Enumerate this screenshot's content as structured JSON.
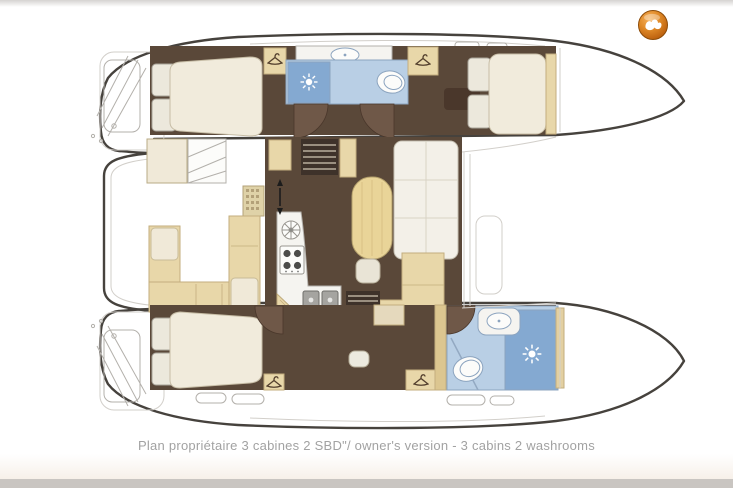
{
  "window": {
    "width": 733,
    "height": 488
  },
  "caption": {
    "text": "Plan propriétaire 3 cabines 2 SBD\"/ owner's version - 3 cabins 2 washrooms"
  },
  "branding": {
    "logo_name": "broker-logo-orange-sphere",
    "logo_glyph": "white-bird-swoosh"
  },
  "palette": {
    "hull-stroke": "#46423d",
    "deck-line": "#c8c5c0",
    "detail-gray": "#b3b0ab",
    "light-gray": "#d2cfca",
    "floor-brown": "#5a4839",
    "door-brown": "#6f5848",
    "dark-wood": "#4a372b",
    "ladder-dark": "#3e322a",
    "cream": "#f0e9d8",
    "cream-dark": "#e5d9bd",
    "tan": "#e8d7a9",
    "tan-dark": "#c3ae7e",
    "table-tan": "#e9d498",
    "counter-white": "#f5f4f0",
    "bath-floor": "#b9cfe5",
    "shower-blue": "#84a9d1",
    "bath-stroke": "#8ca4bf",
    "fixture-white": "#fcfcfa",
    "sink-gray": "#a5a4a0",
    "sink-stroke": "#6f6e6a",
    "burner-dark": "#4c4c4a",
    "mattress": "#f1ebdc",
    "mattress-stroke": "#c7bda6",
    "pillow": "#ece8dc",
    "pillow-stroke": "#a8a399",
    "grid-mat": "#dfd2a8",
    "grid-dot": "#b3a179",
    "arrow-black": "#1c1c1c",
    "icon-brown": "#54402e",
    "logo-orange": "#ce6d13",
    "logo-rim": "#8d4c08",
    "caption-gray": "#a2a2a2",
    "top-bar": "#d5d3d1",
    "bottom-bar": "#c9c5c1",
    "bottom-band": "#f7f0e9",
    "page-white": "#ffffff"
  },
  "plan": {
    "vessel": "catamaran floor plan, bow to the right",
    "rooms": [
      {
        "id": "cockpit",
        "name": "aft cockpit with U-settee and table"
      },
      {
        "id": "saloon",
        "name": "saloon with galley, dining table and sofa"
      },
      {
        "id": "port-aft-cabin",
        "name": "double cabin (port aft)"
      },
      {
        "id": "port-washroom",
        "name": "washroom with shower and toilet (port)"
      },
      {
        "id": "port-forward-cabin",
        "name": "double cabin (port forward)"
      },
      {
        "id": "owner-cabin",
        "name": "owner's double cabin (starboard aft)"
      },
      {
        "id": "owner-washroom",
        "name": "owner's washroom with shower and toilet"
      },
      {
        "id": "foredeck",
        "name": "foredeck between bows"
      }
    ],
    "fixtures": [
      "double-bed",
      "pillows",
      "wardrobe-hanger",
      "shower-sun-rose",
      "toilet",
      "washbasin",
      "double-galley-sink",
      "four-burner-stove",
      "round-burner",
      "oval-dining-table",
      "stool",
      "sofa",
      "companionway-steps",
      "sliding-door-arrows",
      "cockpit-bench",
      "helm-steps",
      "deck-hatch",
      "hull-window",
      "swim-platform",
      "transom-steps"
    ]
  }
}
